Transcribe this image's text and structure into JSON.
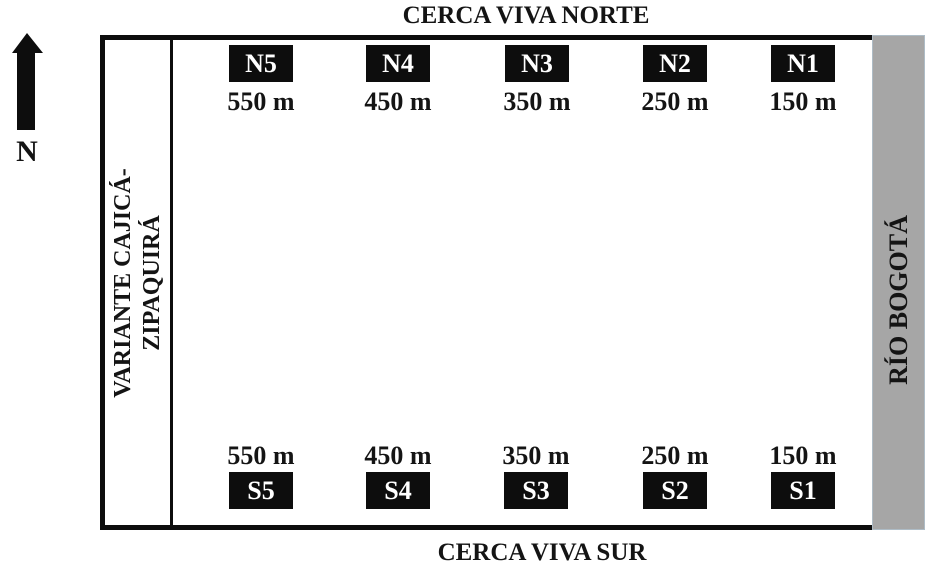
{
  "figure": {
    "compass_label": "N",
    "north_fence_title": "CERCA VIVA NORTE",
    "south_fence_title": "CERCA VIVA SUR",
    "road": {
      "line1": "VARIANTE CAJICÁ-",
      "line2": "ZIPAQUIRÁ"
    },
    "river_label": "RÍO BOGOTÁ"
  },
  "north_stations": [
    {
      "id": "N5",
      "distance": "550 m"
    },
    {
      "id": "N4",
      "distance": "450 m"
    },
    {
      "id": "N3",
      "distance": "350 m"
    },
    {
      "id": "N2",
      "distance": "250 m"
    },
    {
      "id": "N1",
      "distance": "150 m"
    }
  ],
  "south_stations": [
    {
      "id": "S5",
      "distance": "550 m"
    },
    {
      "id": "S4",
      "distance": "450 m"
    },
    {
      "id": "S3",
      "distance": "350 m"
    },
    {
      "id": "S2",
      "distance": "250 m"
    },
    {
      "id": "S1",
      "distance": "150 m"
    }
  ],
  "colors": {
    "river_gray": "#a6a6a6",
    "ink_black": "#0d0d0d",
    "background": "#ffffff"
  }
}
